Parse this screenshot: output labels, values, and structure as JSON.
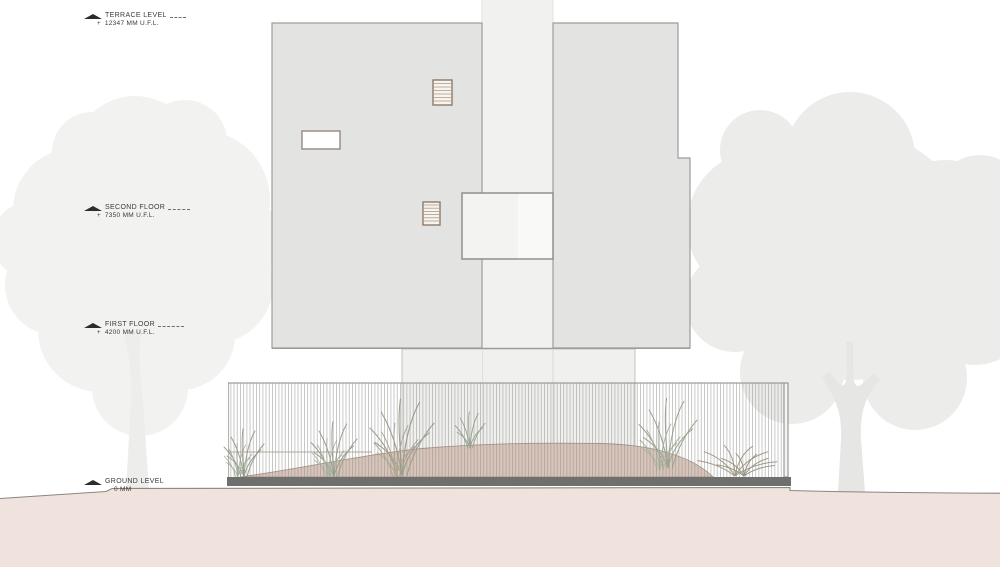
{
  "annotations": {
    "plus": "+",
    "levels": [
      {
        "name": "TERRACE LEVEL",
        "value": "12347 MM U.F.L."
      },
      {
        "name": "SECOND FLOOR",
        "value": "7350 MM U.F.L."
      },
      {
        "name": "FIRST FLOOR",
        "value": "4200 MM U.F.L."
      },
      {
        "name": "GROUND LEVEL",
        "value": "0 MM"
      }
    ]
  },
  "colors": {
    "wall": "#e3e3e2",
    "wall_strip": "#f1f1f0",
    "pedestal": "#f0f0ef",
    "balcony_left": "#f3f3f2",
    "balcony_right": "#f9f9f8",
    "mound": "#d9c4b9",
    "ground": "#f0e3de",
    "fence_base": "#6f6f6d",
    "tree_left": "#f2f2f1",
    "tree_right": "#ececeb",
    "window_frame": "#8d7a68"
  }
}
